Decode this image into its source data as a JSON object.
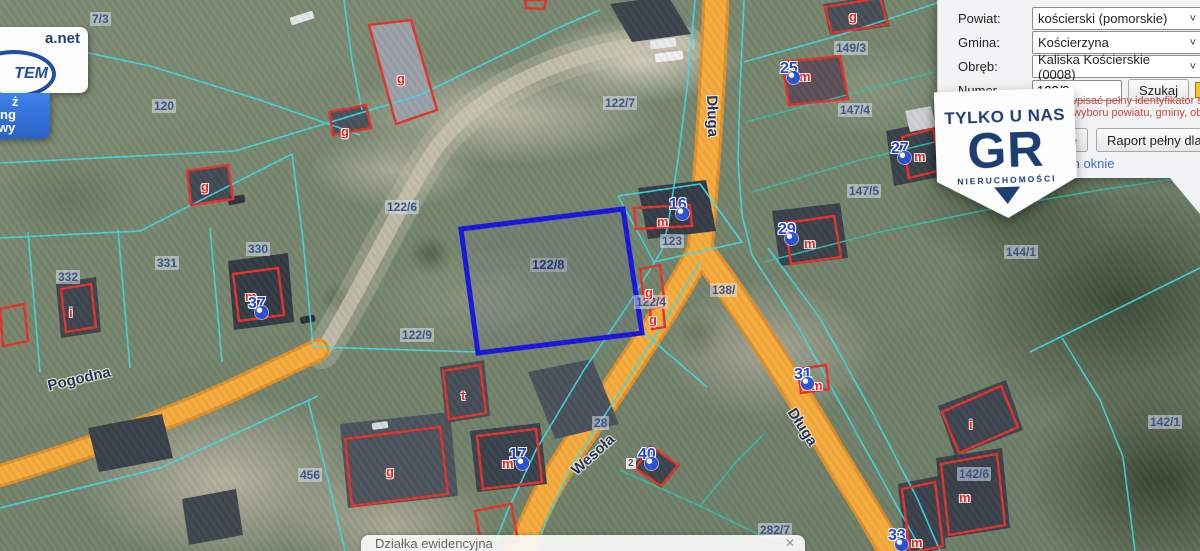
{
  "panel": {
    "rows": [
      {
        "label": "Powiat:",
        "value": "kościerski (pomorskie)"
      },
      {
        "label": "Gmina:",
        "value": "Kościerzyna"
      },
      {
        "label": "Obręb:",
        "value": "Kaliska Kościerskie (0008)"
      }
    ],
    "numer_label": "Numer",
    "numer_value": "122/8",
    "szukaj_label": "Szukaj",
    "hint_line1": "wpisać pełny identyfikator szukanej d",
    "hint_line2": "wyboru powiatu, gminy, obrębu.",
    "btn_partial_label": "e",
    "btn_report_label": "Raport pełny dla dzia",
    "link_partial": "m oknie"
  },
  "badge": {
    "line1": "TYLKO U NAS",
    "line2": "GR",
    "line3": "NIERUCHOMOŚCI"
  },
  "logo_card": {
    "top_text": "a.net",
    "oval_text": "TEM",
    "blue_lines": [
      "ż",
      "ng",
      "wy"
    ]
  },
  "tooltip": {
    "text": "Działka ewidencyjna",
    "close": "✕"
  },
  "map": {
    "selected_parcel": "122/8",
    "colors": {
      "road": "#f6ac3d",
      "parcel_line": "#3edce8",
      "selected": "#1a16dd",
      "building": "#e63228",
      "marker": "#2647d2"
    },
    "streets": [
      {
        "name": "Długa",
        "x": 720,
        "y": 95,
        "rot": 88
      },
      {
        "name": "Długa",
        "x": 798,
        "y": 405,
        "rot": 57
      },
      {
        "name": "Wesoła",
        "x": 568,
        "y": 466,
        "rot": -42
      },
      {
        "name": "Pogodna",
        "x": 46,
        "y": 378,
        "rot": -13
      }
    ],
    "parcel_labels": [
      {
        "t": "7/3",
        "x": 90,
        "y": 12
      },
      {
        "t": "120",
        "x": 152,
        "y": 99
      },
      {
        "t": "122/7",
        "x": 603,
        "y": 96
      },
      {
        "t": "122/6",
        "x": 385,
        "y": 200
      },
      {
        "t": "122/9",
        "x": 400,
        "y": 328
      },
      {
        "t": "122/8",
        "x": 530,
        "y": 258,
        "cls": "sel"
      },
      {
        "t": "123",
        "x": 660,
        "y": 234
      },
      {
        "t": "122/4",
        "x": 634,
        "y": 295
      },
      {
        "t": "138/",
        "x": 710,
        "y": 283
      },
      {
        "t": "149/3",
        "x": 834,
        "y": 41
      },
      {
        "t": "147/4",
        "x": 838,
        "y": 103
      },
      {
        "t": "147/5",
        "x": 847,
        "y": 184
      },
      {
        "t": "144/1",
        "x": 1004,
        "y": 245
      },
      {
        "t": "142/1",
        "x": 1148,
        "y": 415
      },
      {
        "t": "142/6",
        "x": 957,
        "y": 467
      },
      {
        "t": "331",
        "x": 155,
        "y": 256
      },
      {
        "t": "330",
        "x": 246,
        "y": 242
      },
      {
        "t": "332",
        "x": 56,
        "y": 270
      },
      {
        "t": "456",
        "x": 298,
        "y": 468
      },
      {
        "t": "282/7",
        "x": 758,
        "y": 523
      },
      {
        "t": "28",
        "x": 592,
        "y": 416
      }
    ],
    "building_letters": [
      {
        "t": "g",
        "x": 397,
        "y": 72
      },
      {
        "t": "g",
        "x": 341,
        "y": 125
      },
      {
        "t": "g",
        "x": 201,
        "y": 180
      },
      {
        "t": "g",
        "x": 849,
        "y": 10
      },
      {
        "t": "g",
        "x": 645,
        "y": 286
      },
      {
        "t": "g",
        "x": 649,
        "y": 313
      },
      {
        "t": "g",
        "x": 386,
        "y": 465
      },
      {
        "t": "t",
        "x": 461,
        "y": 389
      },
      {
        "t": "i",
        "x": 69,
        "y": 306
      },
      {
        "t": "i",
        "x": 969,
        "y": 418
      },
      {
        "t": "m",
        "x": 657,
        "y": 215
      },
      {
        "t": "m",
        "x": 799,
        "y": 70
      },
      {
        "t": "m",
        "x": 914,
        "y": 150
      },
      {
        "t": "m",
        "x": 804,
        "y": 237
      },
      {
        "t": "m",
        "x": 811,
        "y": 379
      },
      {
        "t": "m",
        "x": 245,
        "y": 290
      },
      {
        "t": "m",
        "x": 502,
        "y": 457
      },
      {
        "t": "m",
        "x": 911,
        "y": 536
      },
      {
        "t": "m",
        "x": 959,
        "y": 491
      }
    ],
    "markers": [
      {
        "n": "16",
        "x": 669,
        "y": 196
      },
      {
        "n": "25",
        "x": 780,
        "y": 60
      },
      {
        "n": "27",
        "x": 891,
        "y": 140
      },
      {
        "n": "29",
        "x": 778,
        "y": 221
      },
      {
        "n": "31",
        "x": 794,
        "y": 366
      },
      {
        "n": "37",
        "x": 248,
        "y": 295
      },
      {
        "n": "17",
        "x": 509,
        "y": 446
      },
      {
        "n": "40",
        "x": 638,
        "y": 446,
        "tag": "2"
      },
      {
        "n": "33",
        "x": 888,
        "y": 527
      }
    ]
  }
}
